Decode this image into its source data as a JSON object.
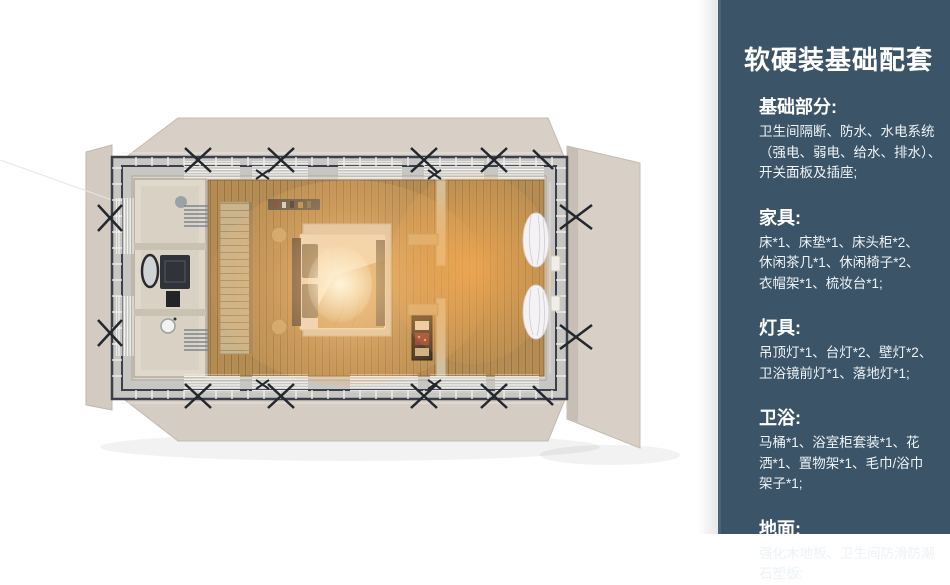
{
  "sidebar": {
    "title": "软硬装基础配套",
    "sections": [
      {
        "label": "基础部分:",
        "body": "卫生间隔断、防水、水电系统\n（强电、弱电、给水、排水）、\n开关面板及插座;"
      },
      {
        "label": "家具:",
        "body": "床*1、床垫*1、床头柜*2、\n休闲茶几*1、休闲椅子*2、\n衣帽架*1、梳妆台*1;"
      },
      {
        "label": "灯具:",
        "body": "吊顶灯*1、台灯*2、壁灯*2、\n卫浴镜前灯*1、落地灯*1;"
      },
      {
        "label": "卫浴:",
        "body": "马桶*1、浴室柜套装*1、花\n洒*1、置物架*1、毛巾/浴巾\n架子*1;"
      },
      {
        "label": "地面:",
        "body": "强化木地板、卫生间防滑防潮\n石塑板;"
      }
    ]
  },
  "colors": {
    "sidebar_bg": "#3b5468",
    "panel_beige": "#d8cfc6",
    "floor_wood": "#b68d55",
    "steel_frame": "#343946",
    "warm_glow": "#ffcf8e"
  }
}
